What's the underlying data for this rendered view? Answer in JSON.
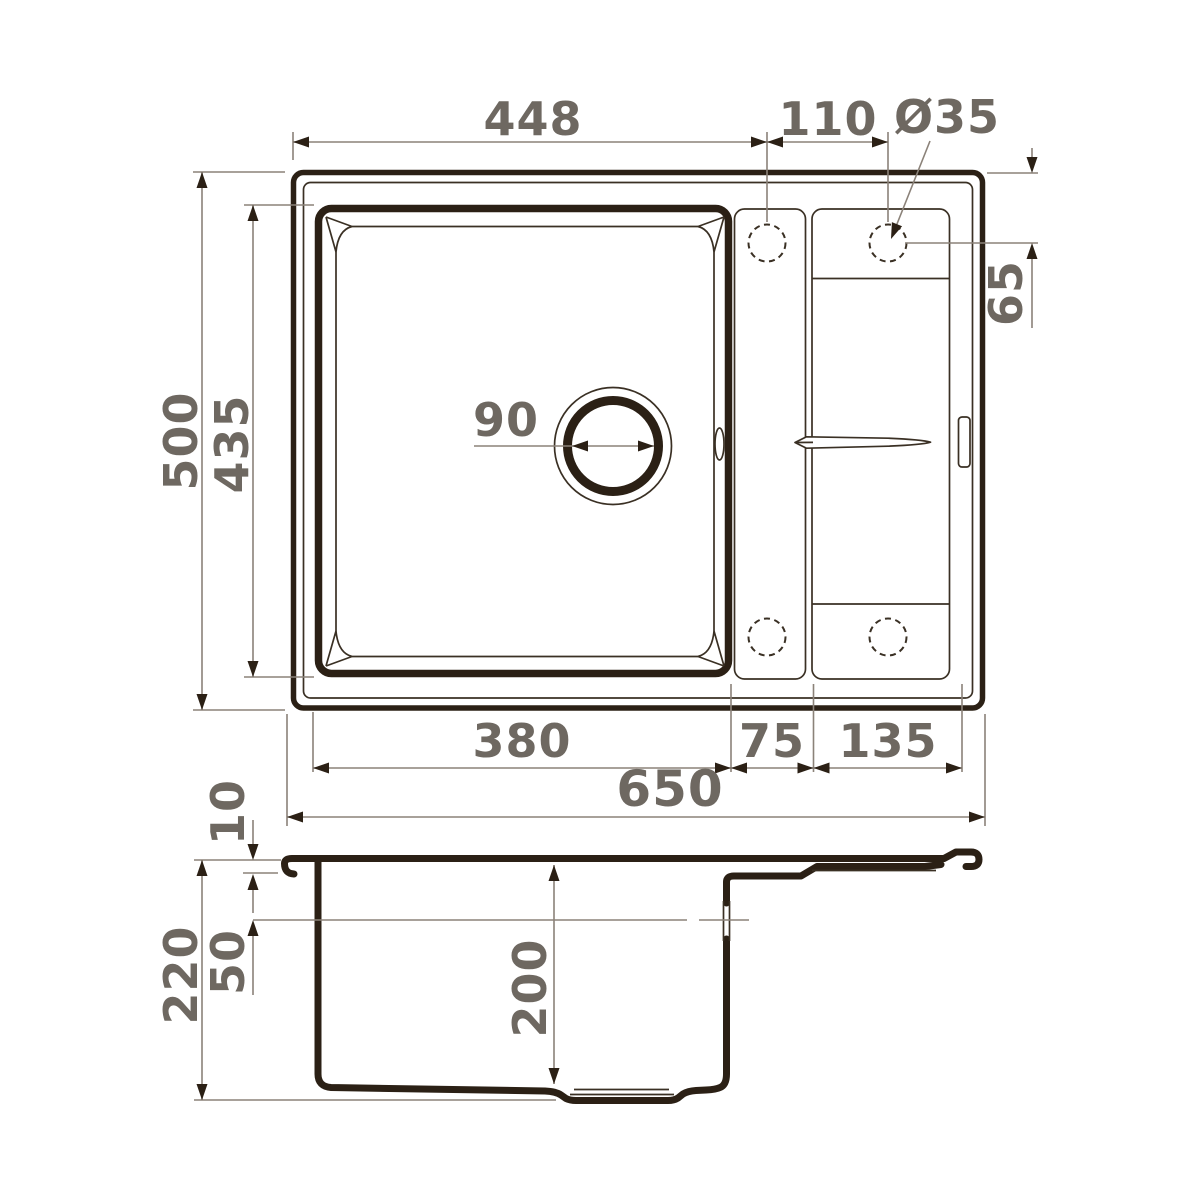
{
  "drawing": {
    "title": "Kitchen sink dimensional drawing",
    "colors": {
      "outline": "#2b2015",
      "dimension_line": "#8b8279",
      "dimension_text": "#6e6861",
      "background": "#ffffff"
    },
    "top_view": {
      "dims": {
        "edge_to_hole": "448",
        "hole_spacing": "110",
        "hole_diameter": "Ø35",
        "hole_offset": "65",
        "overall_depth": "500",
        "bowl_length": "435",
        "drain_diameter": "90",
        "bowl_width": "380",
        "ledge_width": "75",
        "drainboard_width": "135",
        "overall_width": "650"
      }
    },
    "section_view": {
      "dims": {
        "rim_thickness": "10",
        "overall_height": "220",
        "overflow_depth": "50",
        "bowl_depth": "200"
      }
    }
  }
}
